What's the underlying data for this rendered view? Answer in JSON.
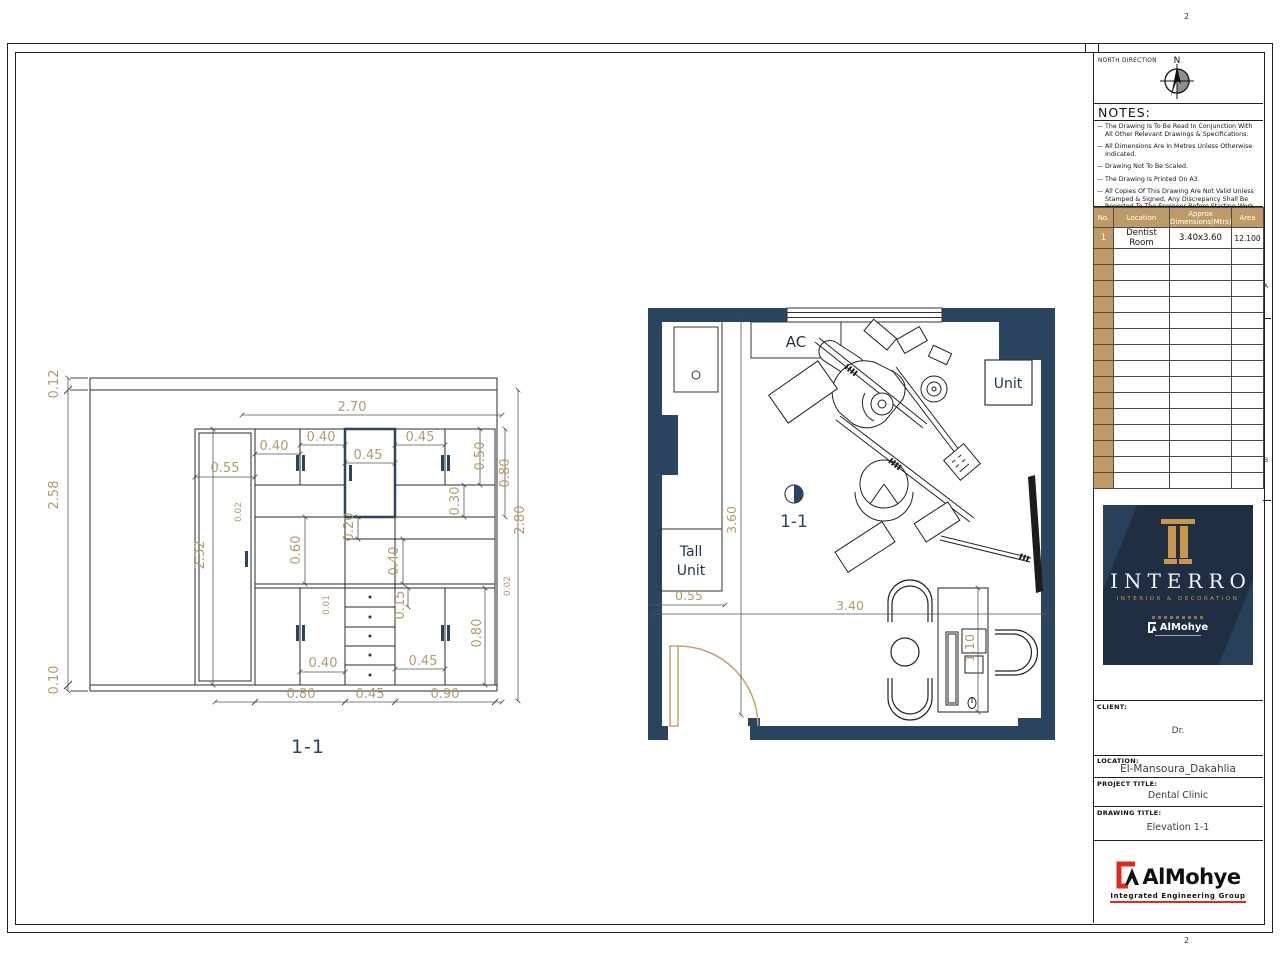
{
  "sheet": {
    "grid_marks": {
      "top": "2",
      "bottom": "2",
      "right_a": "A",
      "right_b": "B"
    }
  },
  "north_box": {
    "label": "NORTH DIRECTION",
    "n": "N"
  },
  "notes": {
    "title": "NOTES:",
    "items": [
      "The Drawing Is To Be Read In Conjunction With All Other Relevant Drawings & Specifications.",
      "All Dimensions Are In Metres Unless Otherwise Indicated.",
      "Drawing Not To Be Scaled.",
      "The Drawing Is Printed On A3.",
      "All Copies Of This Drawing Are Not Valid Unless Stamped & Signed, Any Discrepancy Shall Be Reported To The Engineer Before Starting Work On Site."
    ]
  },
  "schedule": {
    "headers": [
      "No.",
      "Location",
      "Approx Dimensions(Mtrs)",
      "Area"
    ],
    "row": {
      "no": "1",
      "location": "Dentist Room",
      "dims": "3.40x3.60",
      "area": "12.100"
    }
  },
  "brand": {
    "name": "INTERRO",
    "subtitle": "INTERIOR & DECORATION",
    "mini_logo": "AlMohye",
    "bg_color": "#1f2e42",
    "gold_color": "#c9974c"
  },
  "fields": {
    "client_label": "CLIENT:",
    "client_value": "Dr.",
    "location_label": "LOCATION:",
    "location_value": "El-Mansoura_Dakahlia",
    "project_label": "PROJECT TITLE:",
    "project_value": "Dental Clinic",
    "drawing_label": "DRAWING TITLE:",
    "drawing_value": "Elevation 1-1"
  },
  "footer_logo": {
    "name": "AlMohye",
    "tagline": "Integrated Engineering Group",
    "accent_color": "#e02a1e"
  },
  "elevation": {
    "title": "1-1",
    "dims": {
      "d012": "0.12",
      "d258": "2.58",
      "d010": "0.10",
      "d232": "2.32",
      "d055": "0.55",
      "d270": "2.70",
      "d040a": "0.40",
      "d040b": "0.40",
      "d045a": "0.45",
      "d045b": "0.45",
      "d050": "0.50",
      "d080a": "0.80",
      "d030": "0.30",
      "d002a": "0.02",
      "d020": "0.20",
      "d060": "0.60",
      "d040c": "0.40",
      "d002b": "0.02",
      "d001": "0.01",
      "d015": "0.15",
      "d080b": "0.80",
      "d280": "2.80",
      "d040d": "0.40",
      "d045c": "0.45",
      "d080c": "0.80",
      "d045d": "0.45",
      "d090": "0.90"
    }
  },
  "plan": {
    "labels": {
      "ac": "AC",
      "unit": "Unit",
      "tall_line1": "Tall",
      "tall_line2": "Unit",
      "marker": "1-1"
    },
    "dims": {
      "d055": "0.55",
      "d360": "3.60",
      "d340": "3.40",
      "d110": "1.10"
    },
    "wall_color": "#2b4560",
    "dim_color": "#b49a6c",
    "door_color": "#c8a36b"
  }
}
